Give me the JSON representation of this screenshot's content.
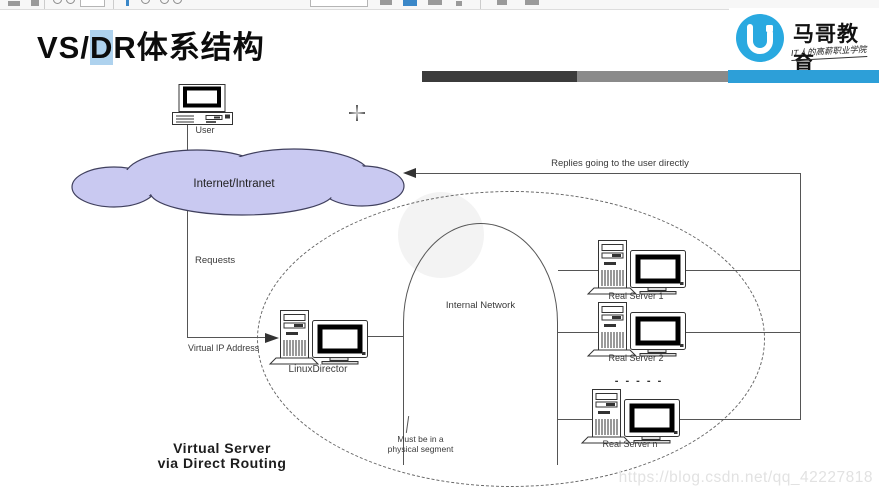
{
  "header": {
    "title_prefix": "VS/",
    "title_highlight": "D",
    "title_suffix": "R体系结构",
    "highlight_color": "#aed2ee"
  },
  "brand": {
    "name": "马哥教育",
    "slogan": "IT人的高薪职业学院",
    "logo_glyph": "U",
    "brand_color": "#29a9e0"
  },
  "progress_bar": {
    "segments": [
      {
        "color": "#3b3b3b"
      },
      {
        "color": "#8a8a8a"
      },
      {
        "color": "#2d9fd8"
      }
    ]
  },
  "diagram": {
    "user_label": "User",
    "cloud_label": "Internet/Intranet",
    "cloud_fill": "#c9c9f1",
    "requests_label": "Requests",
    "virtual_ip_label": "Virtual IP Address",
    "director_label": "LinuxDirector",
    "internal_network_label": "Internal Network",
    "replies_label": "Replies going to the user directly",
    "real_servers": [
      "Real Server 1",
      "Real Server 2",
      "Real Server n"
    ],
    "ellipsis": "- - - - -",
    "segment_note_line1": "Must be in a",
    "segment_note_line2": "physical segment",
    "caption_line1": "Virtual Server",
    "caption_line2": "via Direct Routing"
  },
  "watermark": "https://blog.csdn.net/qq_42227818"
}
